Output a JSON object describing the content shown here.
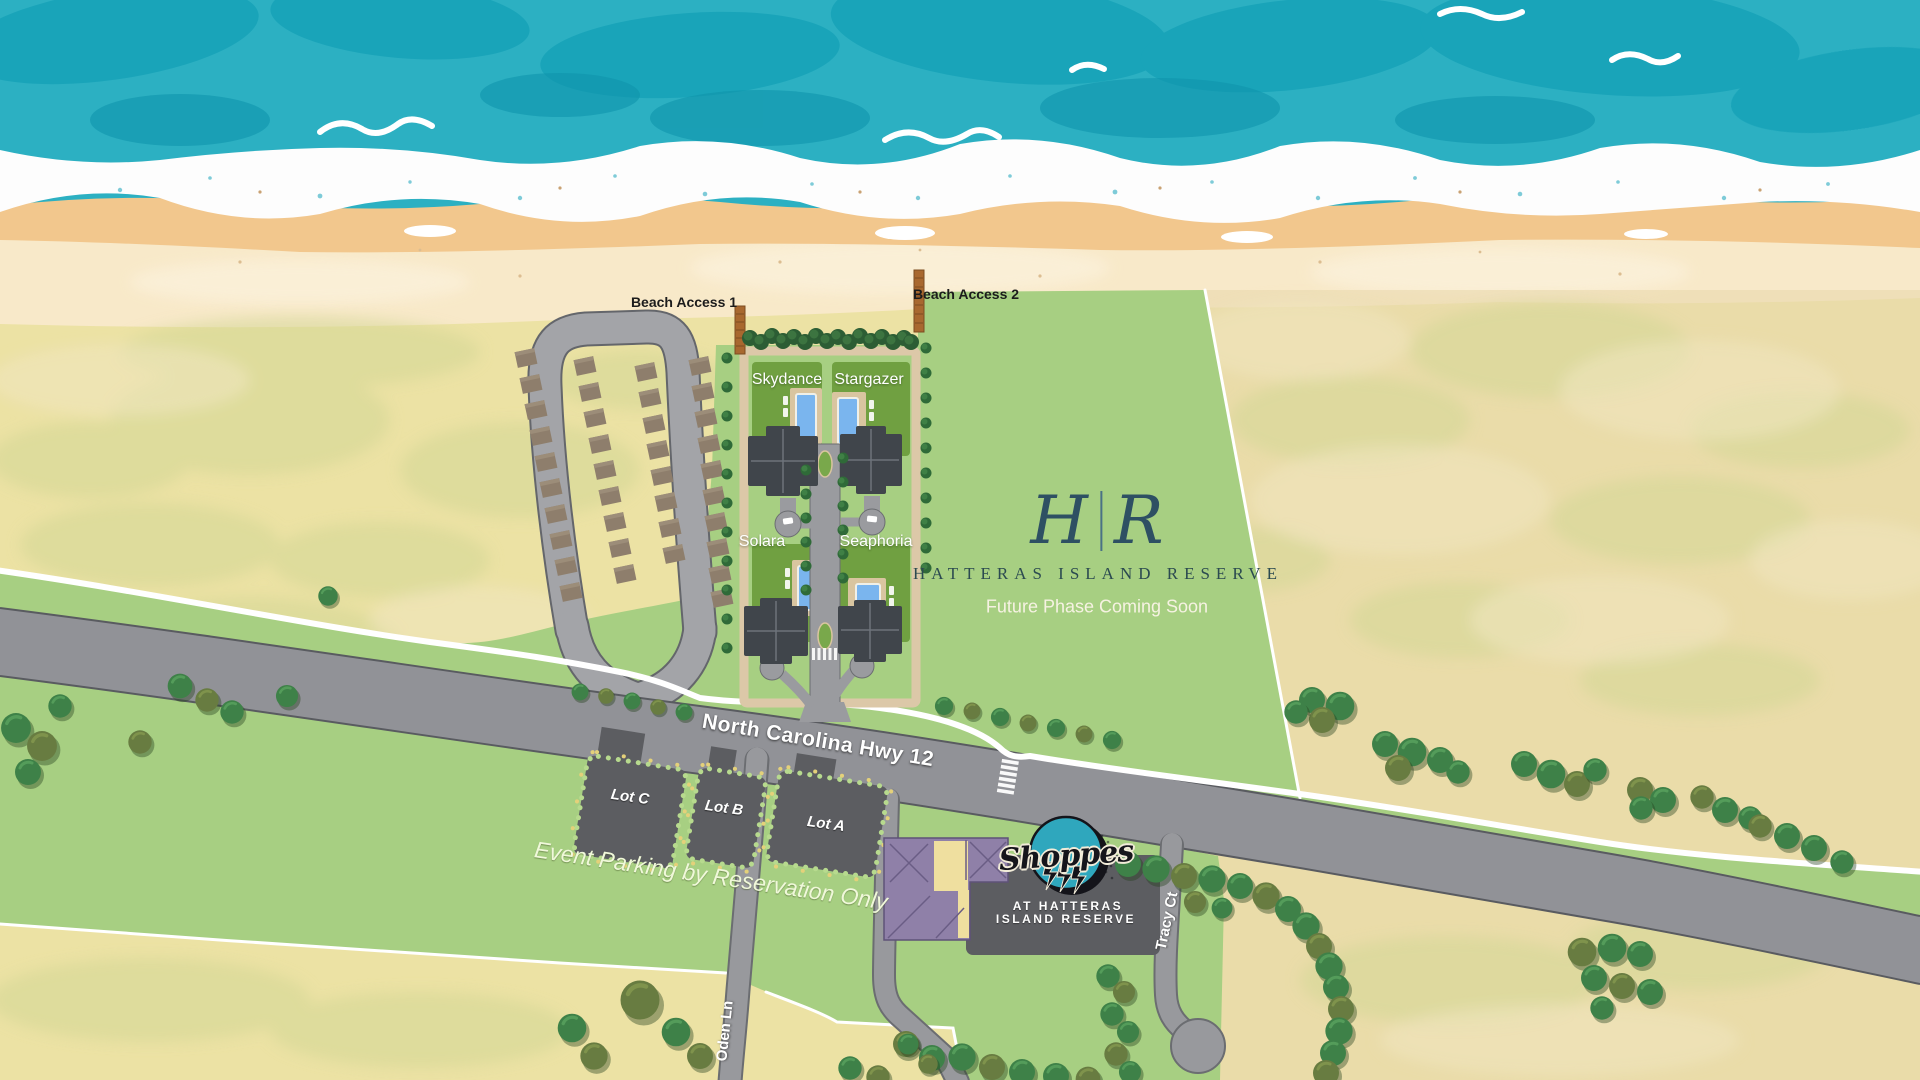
{
  "map": {
    "title": "Hatteras Island Reserve site map",
    "beach_access": {
      "access1": "Beach Access 1",
      "access2": "Beach Access 2"
    },
    "villas": {
      "v1": "Skydance",
      "v2": "Stargazer",
      "v3": "Solara",
      "v4": "Seaphoria"
    },
    "logo": {
      "left_initial": "H",
      "right_initial": "R",
      "name": "HATTERAS ISLAND RESERVE",
      "tagline": "Future Phase Coming Soon"
    },
    "roads": {
      "highway": "North Carolina Hwy 12",
      "oden": "Oden Ln",
      "tracy": "Tracy Ct"
    },
    "parking": {
      "lot_c": "Lot C",
      "lot_b": "Lot B",
      "lot_a": "Lot A",
      "note": "Event Parking by Reservation Only"
    },
    "shoppes": {
      "wordmark": "Shoppes",
      "line1": "AT HATTERAS",
      "line2": "ISLAND RESERVE"
    },
    "colors": {
      "ocean": "#2cb0c2",
      "ocean_deep": "#17a2b8",
      "foam": "#ffffff",
      "wet_sand": "#f2c78d",
      "beach_sand": "#f8e9c9",
      "dune_field": "#ece2a4",
      "grass": "#a7cf82",
      "lawn": "#70a041",
      "road": "#9a9b9f",
      "highway": "#919297",
      "parking_lot": "#5c5d61",
      "pad_brown": "#8e7e6c",
      "boardwalk": "#a8682f",
      "pool": "#7ab5ee",
      "roof_dark": "#40454b",
      "shoppes_teal": "#2fa7bd",
      "shoppes_purple": "#8f80a8",
      "logo_navy": "#2e5063"
    }
  }
}
